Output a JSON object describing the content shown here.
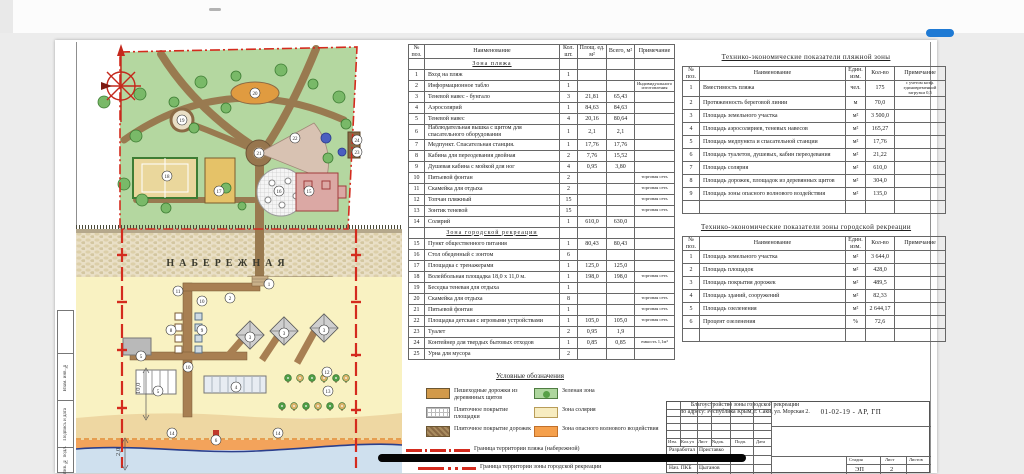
{
  "colors": {
    "boundary_red": "#d42b1e",
    "water_blue": "#2b3f8c",
    "accent_blue": "#1f7ad4"
  },
  "plan": {
    "promenade_label": "НАБЕРЕЖНАЯ",
    "dim_width": "10,0",
    "dim_depth": "2,0",
    "markers": [
      {
        "n": "20",
        "x": 179,
        "y": 53
      },
      {
        "n": "19",
        "x": 106,
        "y": 80
      },
      {
        "n": "22",
        "x": 219,
        "y": 98
      },
      {
        "n": "21",
        "x": 183,
        "y": 113
      },
      {
        "n": "18",
        "x": 91,
        "y": 136
      },
      {
        "n": "17",
        "x": 143,
        "y": 151
      },
      {
        "n": "16",
        "x": 203,
        "y": 151
      },
      {
        "n": "15",
        "x": 233,
        "y": 151
      },
      {
        "n": "24",
        "x": 281,
        "y": 100
      },
      {
        "n": "23",
        "x": 281,
        "y": 112
      },
      {
        "n": "1",
        "x": 193,
        "y": 244
      },
      {
        "n": "2",
        "x": 154,
        "y": 258
      },
      {
        "n": "10",
        "x": 126,
        "y": 261
      },
      {
        "n": "11",
        "x": 102,
        "y": 251
      },
      {
        "n": "8",
        "x": 95,
        "y": 290
      },
      {
        "n": "9",
        "x": 126,
        "y": 290
      },
      {
        "n": "5",
        "x": 65,
        "y": 316
      },
      {
        "n": "10",
        "x": 112,
        "y": 327
      },
      {
        "n": "3",
        "x": 174,
        "y": 297
      },
      {
        "n": "3",
        "x": 208,
        "y": 293
      },
      {
        "n": "3",
        "x": 248,
        "y": 290
      },
      {
        "n": "4",
        "x": 160,
        "y": 347
      },
      {
        "n": "5",
        "x": 82,
        "y": 351
      },
      {
        "n": "12",
        "x": 251,
        "y": 332
      },
      {
        "n": "13",
        "x": 252,
        "y": 351
      },
      {
        "n": "14",
        "x": 96,
        "y": 393
      },
      {
        "n": "14",
        "x": 202,
        "y": 393
      },
      {
        "n": "6",
        "x": 140,
        "y": 400
      }
    ]
  },
  "spec_table": {
    "headers": [
      "№ поз.",
      "Наименование",
      "Кол. шт.",
      "Площ. ед. м²",
      "Всего, м²",
      "Примечание"
    ],
    "sections": [
      {
        "title": "Зона пляжа",
        "rows": [
          [
            "1",
            "Вход на пляж",
            "1",
            "",
            "",
            ""
          ],
          [
            "2",
            "Информационное табло",
            "1",
            "",
            "",
            "Индивидуального изготовления"
          ],
          [
            "3",
            "Теневой навес - бунгало",
            "3",
            "21,81",
            "65,43",
            ""
          ],
          [
            "4",
            "Аэросолярий",
            "1",
            "84,63",
            "84,63",
            ""
          ],
          [
            "5",
            "Теневой навес",
            "4",
            "20,16",
            "80,64",
            ""
          ],
          [
            "6",
            "Наблюдательная вышка с щитом для спасательного оборудования",
            "1",
            "2,1",
            "2,1",
            ""
          ],
          [
            "7",
            "Медпункт. Спасательная станция.",
            "1",
            "17,76",
            "17,76",
            ""
          ],
          [
            "8",
            "Кабина для переодевания двойная",
            "2",
            "7,76",
            "15,52",
            ""
          ],
          [
            "9",
            "Душевая кабина с мойкой для ног",
            "4",
            "0,95",
            "3,80",
            ""
          ],
          [
            "10",
            "Питьевой фонтан",
            "2",
            "",
            "",
            "торговая сеть"
          ],
          [
            "11",
            "Скамейка для отдыха",
            "2",
            "",
            "",
            "торговая сеть"
          ],
          [
            "12",
            "Топчан пляжный",
            "15",
            "",
            "",
            "торговая сеть"
          ],
          [
            "13",
            "Зонтик теневой",
            "15",
            "",
            "",
            "торговая сеть"
          ],
          [
            "14",
            "Солярий",
            "1",
            "610,0",
            "630,0",
            ""
          ]
        ]
      },
      {
        "title": "Зона городской рекреации",
        "rows": [
          [
            "15",
            "Пункт общественного питания",
            "1",
            "80,43",
            "80,43",
            ""
          ],
          [
            "16",
            "Стол обеденный с зонтом",
            "6",
            "",
            "",
            ""
          ],
          [
            "17",
            "Площадка с тренажерами",
            "1",
            "125,0",
            "125,0",
            ""
          ],
          [
            "18",
            "Волейбольная площадка 18,0 х 11,0 м.",
            "1",
            "198,0",
            "198,0",
            "торговая сеть"
          ],
          [
            "19",
            "Беседка теневая для отдыха",
            "1",
            "",
            "",
            ""
          ],
          [
            "20",
            "Скамейка для отдыха",
            "8",
            "",
            "",
            "торговая сеть"
          ],
          [
            "21",
            "Питьевой фонтан",
            "1",
            "",
            "",
            "торговая сеть"
          ],
          [
            "22",
            "Площадка детская с игровыми устройствами",
            "1",
            "105,0",
            "105,0",
            "торговая сеть"
          ],
          [
            "23",
            "Туалет",
            "2",
            "0,95",
            "1,9",
            ""
          ],
          [
            "24",
            "Контейнер для твердых бытовых отходов",
            "1",
            "0,85",
            "0,85",
            "емкость 1,1м³"
          ],
          [
            "25",
            "Урна для мусора",
            "2",
            "",
            "",
            ""
          ]
        ]
      }
    ]
  },
  "tep_beach": {
    "title": "Технико-экономические показатели пляжной зоны",
    "headers": [
      "№ поз.",
      "Наименование",
      "Един. изм.",
      "Кол-во",
      "Примечание"
    ],
    "rows": [
      [
        "1",
        "Вместимость пляжа",
        "чел.",
        "175",
        "с учетом коэф. единовременной загрузки 0,5"
      ],
      [
        "2",
        "Протяженность береговой линии",
        "м",
        "70,0",
        ""
      ],
      [
        "3",
        "Площадь земельного участка",
        "м²",
        "3 500,0",
        ""
      ],
      [
        "4",
        "Площадь аэросоляриев, теневых навесов",
        "м²",
        "165,27",
        ""
      ],
      [
        "5",
        "Площадь медпункта и спасательной станции",
        "м²",
        "17,76",
        ""
      ],
      [
        "6",
        "Площадь туалетов, душевых, кабин переодевания",
        "м²",
        "21,22",
        ""
      ],
      [
        "7",
        "Площадь солярия",
        "м²",
        "610,0",
        ""
      ],
      [
        "8",
        "Площадь дорожек, площадок из деревянных щитов",
        "м²",
        "304,0",
        ""
      ],
      [
        "9",
        "Площадь зоны опасного волнового воздействия",
        "м²",
        "135,0",
        ""
      ]
    ]
  },
  "tep_recreation": {
    "title": "Технико-экономические показатели зоны городской рекреации",
    "headers": [
      "№ поз.",
      "Наименование",
      "Един. изм.",
      "Кол-во",
      "Примечание"
    ],
    "rows": [
      [
        "1",
        "Площадь земельного участка",
        "м²",
        "3 644,0",
        ""
      ],
      [
        "2",
        "Площадь площадок",
        "м²",
        "428,0",
        ""
      ],
      [
        "3",
        "Площадь покрытия дорожек",
        "м²",
        "489,5",
        ""
      ],
      [
        "4",
        "Площадь зданий, сооружений",
        "м²",
        "82,33",
        ""
      ],
      [
        "5",
        "Площадь озеленения",
        "м²",
        "2 644,17",
        ""
      ],
      [
        "6",
        "Процент озеленения",
        "%",
        "72,6",
        ""
      ]
    ]
  },
  "legend": {
    "title": "Условные обозначения",
    "items": [
      {
        "key": "wood-walk",
        "label": "Пешеходные дорожки из деревянных щитов"
      },
      {
        "key": "tile-area",
        "label": "Плиточное покрытие площадки"
      },
      {
        "key": "tile-path",
        "label": "Плиточное покрытие дорожек"
      },
      {
        "key": "green-zone",
        "label": "Зеленая зона"
      },
      {
        "key": "solarium-zone",
        "label": "Зона солярия"
      },
      {
        "key": "wave-zone",
        "label": "Зона опасного волнового воздействия"
      }
    ],
    "lines": [
      {
        "key": "beach-boundary",
        "label": "Граница территории пляжа (набережной)"
      },
      {
        "key": "recreation-boundary",
        "label": "Граница территории зоны городской рекреации"
      }
    ]
  },
  "stamp": {
    "doc_number": "01-02-19 - АР, ГП",
    "project_line1": "Благоустройство зоны городской рекреации",
    "project_line2": "по адресу: Республика Крым, г. Саки, ул. Морская 2.",
    "header_cells": [
      "Изм.",
      "Кол.уч",
      "Лист",
      "№док.",
      "Подп.",
      "Дата"
    ],
    "roles": [
      {
        "role": "Разработал",
        "name": "Приставко"
      },
      {
        "role": "Нач. ПКБ",
        "name": "Цыганов"
      }
    ],
    "stage_headers": [
      "Стадия",
      "Лист",
      "Листов"
    ],
    "stage": "ЭП",
    "sheet": "2",
    "sheets": ""
  },
  "frame": {
    "labels": [
      "Взам. инв. №",
      "Подпись и дата",
      "Инв. № подл."
    ]
  }
}
